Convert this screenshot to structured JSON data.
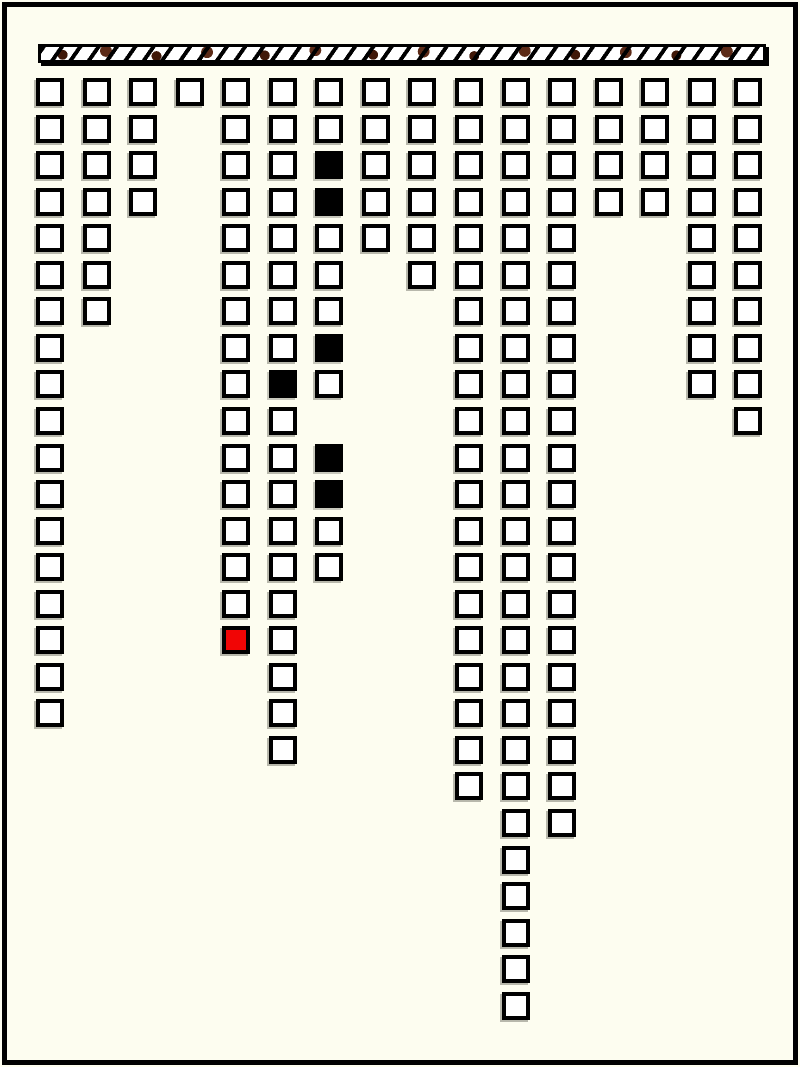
{
  "window": {
    "background_color": "#fdfdf0",
    "border_color": "#000000"
  },
  "ceiling_bar": {
    "description": "hatched-bar",
    "stripe_color": "#000000",
    "base_color": "#ffffff",
    "spot_colors": [
      "#401808",
      "#5c2a16"
    ]
  },
  "board": {
    "square_size": 28,
    "origin_x": 29,
    "origin_y": 71,
    "col_spacing": 46.55,
    "row_spacing": 36.55,
    "colors": {
      "white": "#ffffff",
      "black": "#000000",
      "red": "#f10505"
    },
    "columns": [
      {
        "rows": [
          [
            1,
            18
          ]
        ]
      },
      {
        "rows": [
          [
            1,
            7
          ]
        ]
      },
      {
        "rows": [
          [
            1,
            4
          ]
        ]
      },
      {
        "rows": [
          [
            1,
            1
          ]
        ]
      },
      {
        "rows": [
          [
            1,
            16
          ]
        ],
        "red": [
          16
        ]
      },
      {
        "rows": [
          [
            1,
            19
          ]
        ],
        "black": [
          9
        ]
      },
      {
        "rows": [
          [
            1,
            9
          ],
          [
            11,
            14
          ]
        ],
        "black": [
          3,
          4,
          8,
          11,
          12
        ]
      },
      {
        "rows": [
          [
            1,
            5
          ]
        ]
      },
      {
        "rows": [
          [
            1,
            6
          ]
        ]
      },
      {
        "rows": [
          [
            1,
            20
          ]
        ]
      },
      {
        "rows": [
          [
            1,
            26
          ]
        ]
      },
      {
        "rows": [
          [
            1,
            21
          ]
        ]
      },
      {
        "rows": [
          [
            1,
            4
          ]
        ]
      },
      {
        "rows": [
          [
            1,
            4
          ]
        ]
      },
      {
        "rows": [
          [
            1,
            9
          ]
        ]
      },
      {
        "rows": [
          [
            1,
            10
          ]
        ]
      }
    ]
  }
}
